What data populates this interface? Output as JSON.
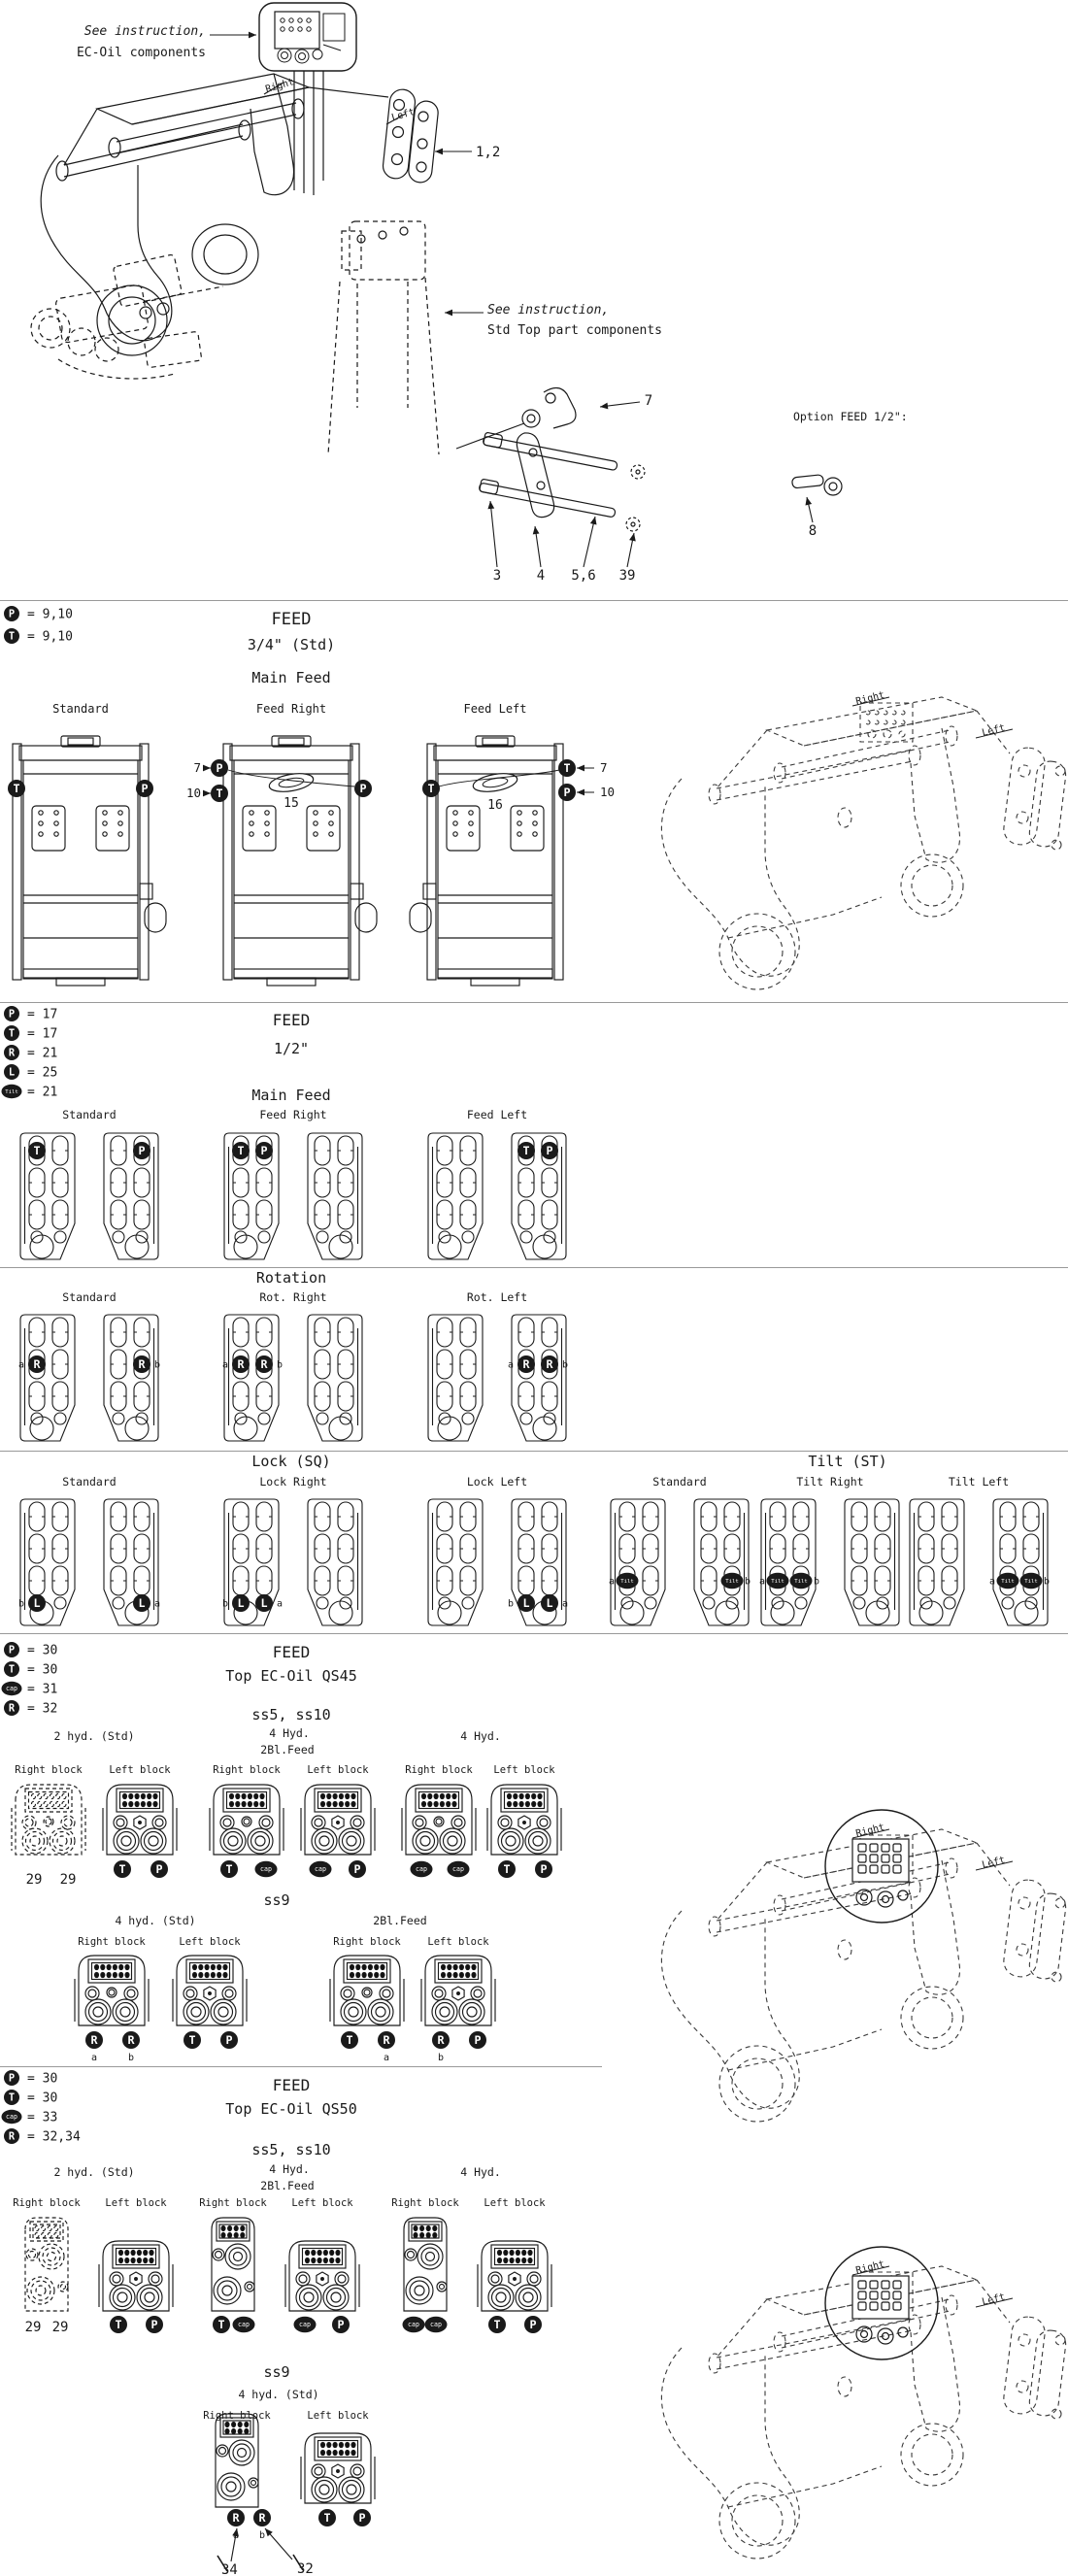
{
  "colors": {
    "ink": "#1a1a1a",
    "divider": "#999999",
    "badge_fill": "#111111",
    "badge_text": "#ffffff"
  },
  "strings": {
    "right": "Right",
    "left": "Left",
    "right_block": "Right block",
    "left_block": "Left block"
  },
  "sec1": {
    "note_ec1": "See instruction,",
    "note_ec2": "EC-Oil components",
    "note_std1": "See instruction,",
    "note_std2": "Std Top part components",
    "c12": "1,2",
    "c7": "7",
    "c3": "3",
    "c4": "4",
    "c56": "5,6",
    "c39": "39",
    "option": "Option FEED 1/2\":",
    "c8": "8"
  },
  "sec2": {
    "legend": [
      {
        "b": "P",
        "v": "= 9,10"
      },
      {
        "b": "T",
        "v": "= 9,10"
      }
    ],
    "title": "FEED",
    "sub": "3/4\" (Std)",
    "row": "Main Feed",
    "cols": [
      "Standard",
      "Feed Right",
      "Feed Left"
    ],
    "n15": "15",
    "n16": "16",
    "c7": "7",
    "c10": "10"
  },
  "sec3": {
    "legend": [
      {
        "b": "P",
        "v": "= 17"
      },
      {
        "b": "T",
        "v": "= 17"
      },
      {
        "b": "R",
        "v": "= 21"
      },
      {
        "b": "L",
        "v": "= 25"
      },
      {
        "b": "Tilt",
        "v": "= 21"
      }
    ],
    "title": "FEED",
    "sub": "1/2\"",
    "rows": [
      {
        "title": "Main Feed",
        "groups": [
          {
            "label": "Standard",
            "badges": [
              {
                "p": 0,
                "r": 1,
                "s": 0,
                "t": "T"
              },
              {
                "p": 1,
                "r": 1,
                "s": 1,
                "t": "P"
              }
            ]
          },
          {
            "label": "Feed Right",
            "badges": [
              {
                "p": 0,
                "r": 1,
                "s": 0,
                "t": "T"
              },
              {
                "p": 0,
                "r": 1,
                "s": 1,
                "t": "P"
              }
            ]
          },
          {
            "label": "Feed Left",
            "badges": [
              {
                "p": 1,
                "r": 1,
                "s": 0,
                "t": "T"
              },
              {
                "p": 1,
                "r": 1,
                "s": 1,
                "t": "P"
              }
            ]
          }
        ]
      },
      {
        "title": "Rotation",
        "groups": [
          {
            "label": "Standard",
            "badges": [
              {
                "p": 0,
                "r": 2,
                "s": 0,
                "t": "R",
                "pre": "a"
              },
              {
                "p": 1,
                "r": 2,
                "s": 1,
                "t": "R",
                "post": "b"
              }
            ]
          },
          {
            "label": "Rot. Right",
            "badges": [
              {
                "p": 0,
                "r": 2,
                "s": 0,
                "t": "R",
                "pre": "a"
              },
              {
                "p": 0,
                "r": 2,
                "s": 1,
                "t": "R",
                "post": "b"
              }
            ]
          },
          {
            "label": "Rot. Left",
            "badges": [
              {
                "p": 1,
                "r": 2,
                "s": 0,
                "t": "R",
                "pre": "a"
              },
              {
                "p": 1,
                "r": 2,
                "s": 1,
                "t": "R",
                "post": "b"
              }
            ]
          }
        ]
      },
      {
        "title": "Lock (SQ)",
        "groups": [
          {
            "label": "Standard",
            "badges": [
              {
                "p": 0,
                "r": 4,
                "s": 0,
                "t": "L",
                "pre": "b"
              },
              {
                "p": 1,
                "r": 4,
                "s": 1,
                "t": "L",
                "post": "a"
              }
            ]
          },
          {
            "label": "Lock Right",
            "badges": [
              {
                "p": 0,
                "r": 4,
                "s": 0,
                "t": "L",
                "pre": "b"
              },
              {
                "p": 0,
                "r": 4,
                "s": 1,
                "t": "L",
                "post": "a"
              }
            ]
          },
          {
            "label": "Lock Left",
            "badges": [
              {
                "p": 1,
                "r": 4,
                "s": 0,
                "t": "L",
                "pre": "b"
              },
              {
                "p": 1,
                "r": 4,
                "s": 1,
                "t": "L",
                "post": "a"
              }
            ]
          }
        ]
      },
      {
        "title": "Tilt (ST)",
        "groups": [
          {
            "label": "Standard",
            "badges": [
              {
                "p": 0,
                "r": 3,
                "s": 0,
                "t": "Tilt",
                "pre": "a"
              },
              {
                "p": 1,
                "r": 3,
                "s": 1,
                "t": "Tilt",
                "post": "b"
              }
            ]
          },
          {
            "label": "Tilt Right",
            "badges": [
              {
                "p": 0,
                "r": 3,
                "s": 0,
                "t": "Tilt",
                "pre": "a"
              },
              {
                "p": 0,
                "r": 3,
                "s": 1,
                "t": "Tilt",
                "post": "b"
              }
            ]
          },
          {
            "label": "Tilt Left",
            "badges": [
              {
                "p": 1,
                "r": 3,
                "s": 0,
                "t": "Tilt",
                "pre": "a"
              },
              {
                "p": 1,
                "r": 3,
                "s": 1,
                "t": "Tilt",
                "post": "b"
              }
            ]
          }
        ]
      }
    ]
  },
  "sec4": {
    "legend": [
      {
        "b": "P",
        "v": "= 30"
      },
      {
        "b": "T",
        "v": "= 30"
      },
      {
        "b": "cap",
        "v": "= 31"
      },
      {
        "b": "R",
        "v": "= 32"
      }
    ],
    "title": "FEED",
    "sub": "Top EC-Oil QS45",
    "row1": {
      "title": "ss5, ss10",
      "cols": [
        {
          "label": "2 hyd. (Std)",
          "right": {
            "dashed": true,
            "nums": [
              "29",
              "29"
            ]
          },
          "left": {
            "badges": [
              "T",
              "P"
            ]
          }
        },
        {
          "label": "4 Hyd.",
          "label2": "2Bl.Feed",
          "right": {
            "badges": [
              "T",
              "cap"
            ]
          },
          "left": {
            "badges": [
              "cap",
              "P"
            ]
          }
        },
        {
          "label": "4 Hyd.",
          "right": {
            "badges": [
              "cap",
              "cap"
            ]
          },
          "left": {
            "badges": [
              "T",
              "P"
            ]
          }
        }
      ]
    },
    "row2": {
      "title": "ss9",
      "cols": [
        {
          "label": "4 hyd. (Std)",
          "right": {
            "badges": [
              "R",
              "R"
            ],
            "subs": [
              "a",
              "b"
            ]
          },
          "left": {
            "badges": [
              "T",
              "P"
            ]
          }
        },
        {
          "label": "2Bl.Feed",
          "right": {
            "badges": [
              "T",
              "R"
            ],
            "subs": [
              "",
              "a"
            ]
          },
          "left": {
            "badges": [
              "R",
              "P"
            ],
            "subs": [
              "b",
              ""
            ]
          }
        }
      ]
    }
  },
  "sec5": {
    "legend": [
      {
        "b": "P",
        "v": "= 30"
      },
      {
        "b": "T",
        "v": "= 30"
      },
      {
        "b": "cap",
        "v": "= 33"
      },
      {
        "b": "R",
        "v": "= 32,34"
      }
    ],
    "title": "FEED",
    "sub": "Top EC-Oil QS50",
    "row1": {
      "title": "ss5, ss10",
      "cols": [
        {
          "label": "2 hyd. (Std)",
          "right": {
            "dashed": true,
            "nums": [
              "29",
              "29"
            ]
          },
          "left": {
            "badges": [
              "T",
              "P"
            ]
          }
        },
        {
          "label": "4 Hyd.",
          "label2": "2Bl.Feed",
          "right": {
            "badges": [
              "T",
              "cap"
            ]
          },
          "left": {
            "badges": [
              "cap",
              "P"
            ]
          }
        },
        {
          "label": "4 Hyd.",
          "right": {
            "badges": [
              "cap",
              "cap"
            ]
          },
          "left": {
            "badges": [
              "T",
              "P"
            ]
          }
        }
      ]
    },
    "row2": {
      "title": "ss9",
      "cols": [
        {
          "label": "4 hyd. (Std)",
          "right": {
            "badges": [
              "R",
              "R"
            ],
            "subs": [
              "a",
              "b"
            ],
            "callouts": [
              "34",
              "32"
            ]
          },
          "left": {
            "badges": [
              "T",
              "P"
            ]
          }
        }
      ]
    }
  }
}
